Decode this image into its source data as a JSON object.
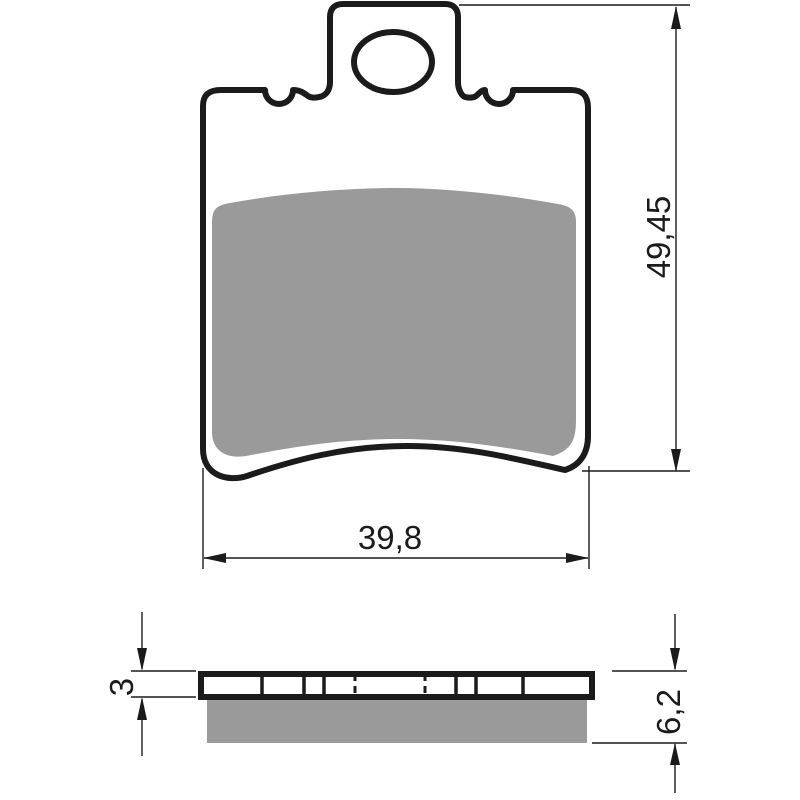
{
  "drawing": {
    "part": "brake-pad",
    "views": {
      "front": {
        "name": "front-view"
      },
      "side": {
        "name": "side-view"
      }
    },
    "dimensions": {
      "height": {
        "value": "49,45"
      },
      "width": {
        "value": "39,8"
      },
      "backing_plate_thickness": {
        "value": "3"
      },
      "total_thickness": {
        "value": "6,2"
      }
    },
    "colors": {
      "line": "#1b1b1b",
      "friction_material": "#9a9a9a",
      "plate_fill": "#ffffff",
      "background": "#ffffff"
    }
  }
}
